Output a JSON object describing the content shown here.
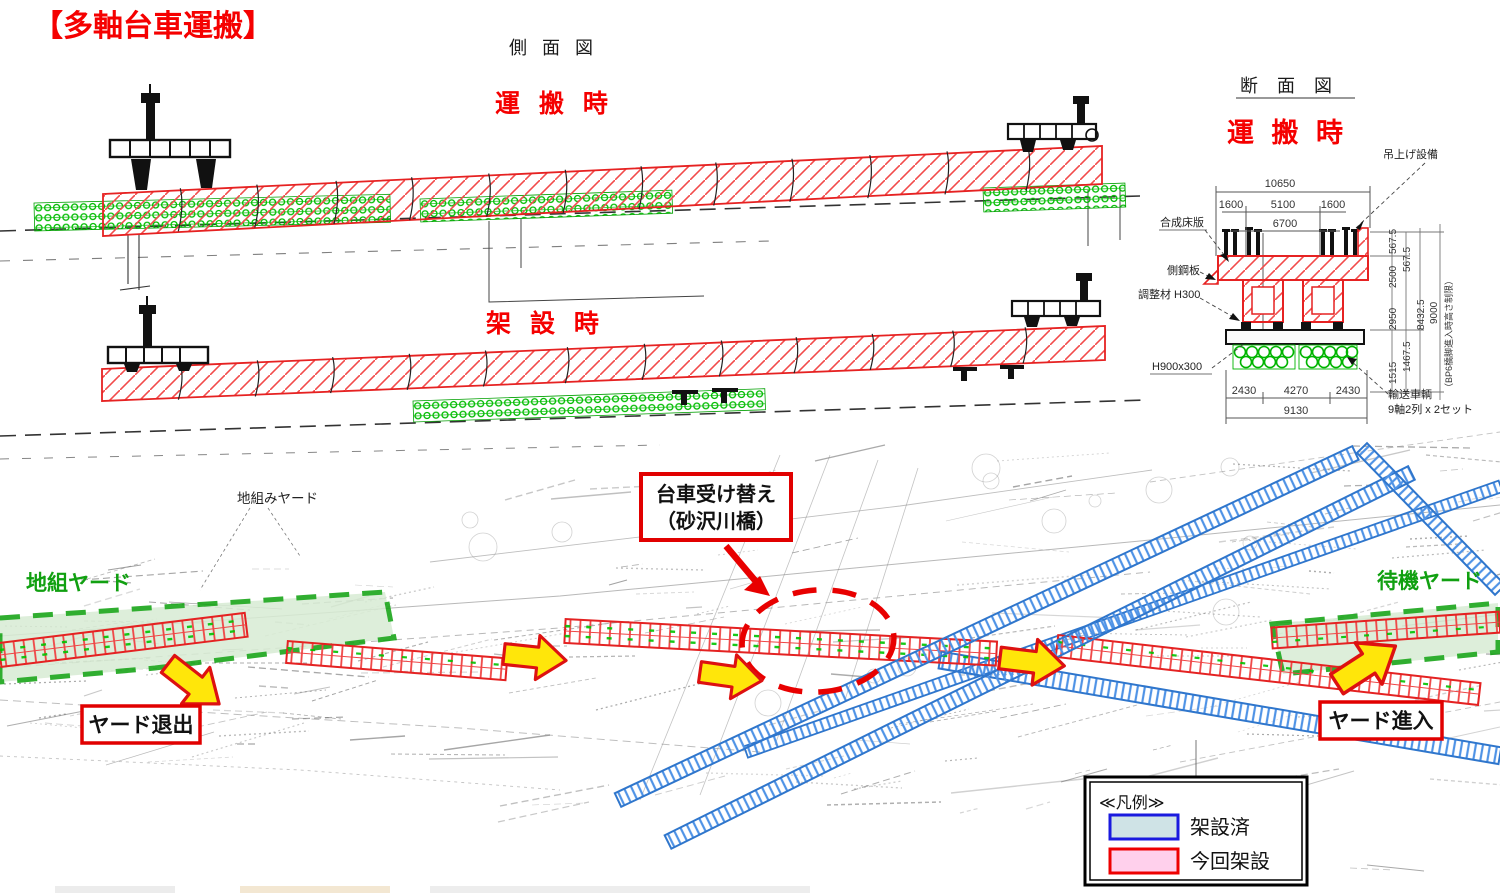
{
  "title": "【多軸台車運搬】",
  "side_view": {
    "heading": "側 面 図",
    "transport_label": "運 搬 時",
    "erection_label": "架 設 時"
  },
  "cross_section": {
    "heading": "断 面 図",
    "state_label": "運 搬 時",
    "labels": {
      "lifting": "吊上げ設備",
      "deck": "合成床版",
      "side_plate": "側鋼板",
      "shim": "調整材 H300",
      "beam": "H900x300",
      "carrier_line1": "輸送車輌",
      "carrier_line2": "9軸2列 x 2セット"
    },
    "dims": {
      "total_width": "10650",
      "w_left": "1600",
      "w_center": "5100",
      "w_right": "1600",
      "inner": "6700",
      "b_left": "2430",
      "b_center": "4270",
      "b_right": "2430",
      "b_total": "9130",
      "v_1515": "1515",
      "v_2950": "2950",
      "v_2500": "2500",
      "v_567a": "567.5",
      "v_567b": "567.5",
      "v_1467": "1467.5",
      "v_8432": "8432.5",
      "v_9000": "9000",
      "v_note": "（BP6橋脚進入時高さ制限）"
    }
  },
  "plan_view": {
    "assembly_yard_note": "地組みヤード",
    "assembly_yard": "地組ヤード",
    "waiting_yard": "待機ヤード",
    "yard_exit": "ヤード退出",
    "yard_entry": "ヤード進入",
    "bogie_change_line1": "台車受け替え",
    "bogie_change_line2": "（砂沢川橋）"
  },
  "legend": {
    "title": "≪凡例≫",
    "erected": "架設済",
    "current": "今回架設"
  },
  "colors": {
    "accent_red": "#e10000",
    "girder_red": "#e62222",
    "trolley_green": "#00bb00",
    "yard_green": "#11a011",
    "erected_blue": "#3b82d8",
    "arrow_yellow": "#ffe60a",
    "legend_erected_fill": "#cfe3e6",
    "legend_erected_border": "#1a1adf",
    "legend_current_fill": "#ffd0ec",
    "legend_current_border": "#ee0000"
  }
}
